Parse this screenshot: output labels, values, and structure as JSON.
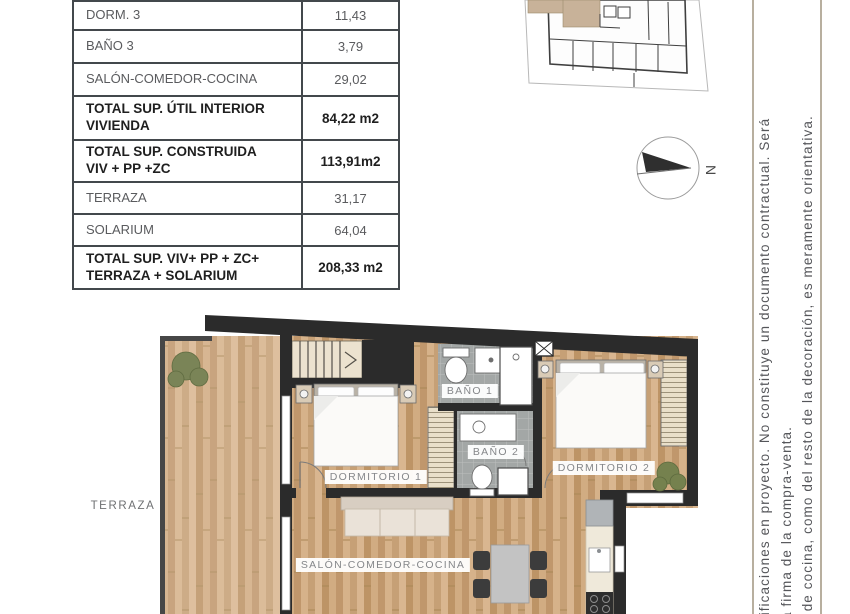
{
  "sheet": {
    "area_table": {
      "rows": [
        {
          "label": "DORM. 3",
          "value": "11,43"
        },
        {
          "label": "BAÑO 3",
          "value": "3,79"
        },
        {
          "label": "SALÓN-COMEDOR-COCINA",
          "value": "29,02"
        },
        {
          "label": "TOTAL SUP. ÚTIL INTERIOR\nVIVIENDA",
          "value": "84,22 m2"
        },
        {
          "label": "TOTAL SUP. CONSTRUIDA\nVIV + PP +ZC",
          "value": "113,91m2"
        },
        {
          "label": "TERRAZA",
          "value": "31,17"
        },
        {
          "label": "SOLARIUM",
          "value": "64,04"
        },
        {
          "label": "TOTAL SUP. VIV+ PP + ZC+\nTERRAZA + SOLARIUM",
          "value": "208,33 m2"
        }
      ]
    },
    "floor_plan": {
      "labels": {
        "terraza": "TERRAZA",
        "dormitorio1": "DORMITORIO 1",
        "bano1": "BAÑO 1",
        "bano2": "BAÑO 2",
        "dormitorio2": "DORMITORIO 2",
        "salon": "SALÓN-COMEDOR-COCINA"
      },
      "compass": {
        "north_label": "N"
      }
    },
    "disclaimer": {
      "line1": "dificaciones en proyecto. No constituye un documento contractual. Será",
      "line2": "a firma de la compra-venta.",
      "line3": "s de cocina, como del resto de la decoración, es meramente orientativa."
    },
    "colors": {
      "wall": "#2b2b2b",
      "wood": "#cda87f",
      "tile": "#a3a7a6",
      "highlight_unit": "#c8b299"
    }
  }
}
